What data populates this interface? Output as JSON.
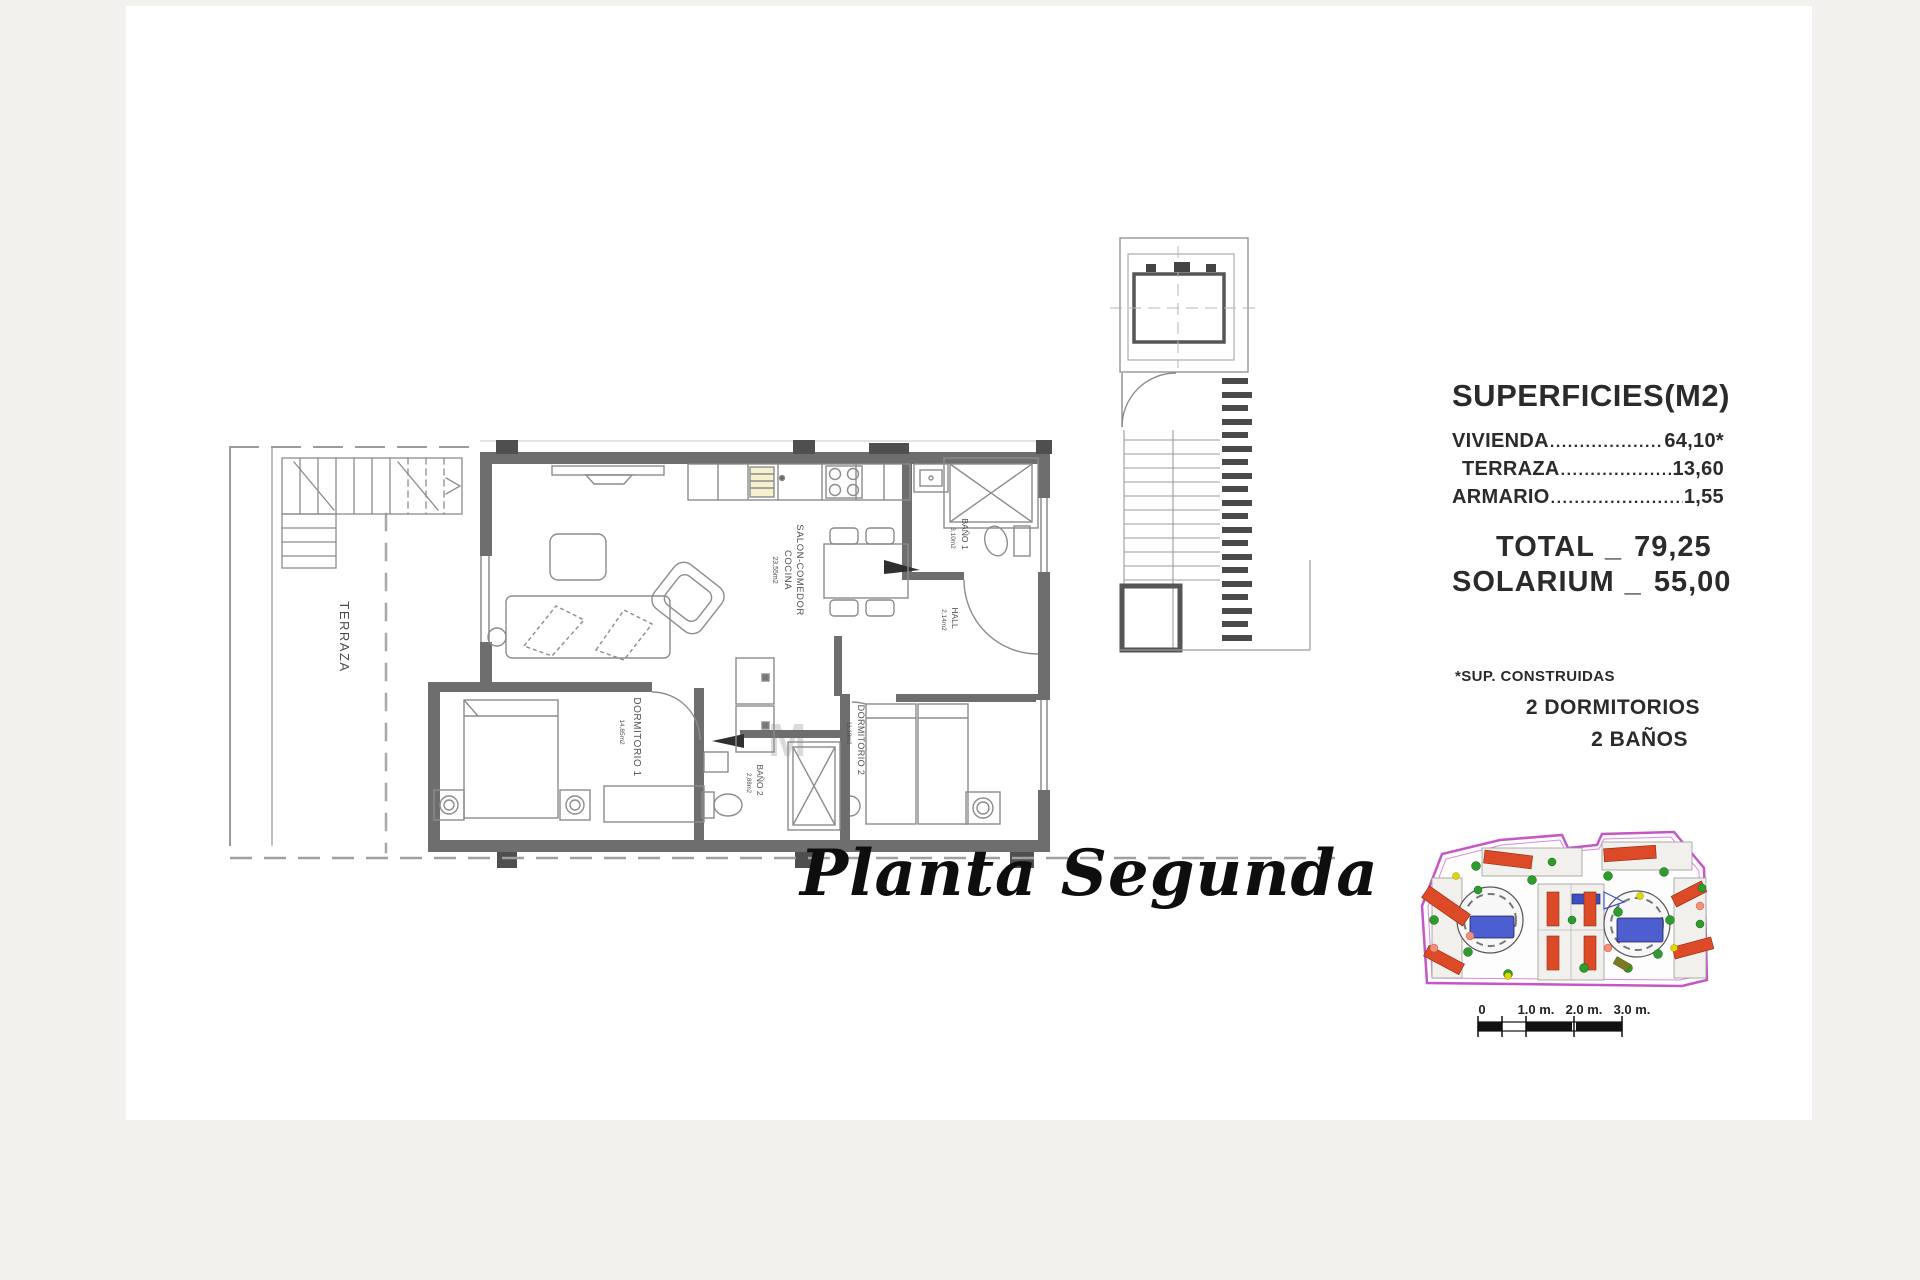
{
  "title": "Planta Segunda",
  "panel": {
    "heading": "SUPERFICIES(M2)",
    "rows": [
      {
        "label": "VIVIENDA",
        "value": "64,10*"
      },
      {
        "label": "TERRAZA",
        "value": "13,60"
      },
      {
        "label": "ARMARIO",
        "value": "1,55"
      }
    ],
    "total": {
      "label": "TOTAL",
      "sep": "_",
      "value": "79,25"
    },
    "solarium": {
      "label": "SOLARIUM",
      "sep": "_",
      "value": "55,00"
    },
    "footnote": "*SUP. CONSTRUIDAS",
    "features": [
      "2 DORMITORIOS",
      "2 BAÑOS"
    ]
  },
  "plan": {
    "rooms": {
      "terraza": {
        "name": "TERRAZA"
      },
      "salon": {
        "line1": "SALON-COMEDOR",
        "line2": "COCINA",
        "area": "23,55m2"
      },
      "dormitorio1": {
        "name": "DORMITORIO 1",
        "area": "14,85m2"
      },
      "dormitorio2": {
        "name": "DORMITORIO 2",
        "area": "11,18m2"
      },
      "bano1": {
        "name": "BAÑO 1",
        "area": "3,10m2"
      },
      "bano2": {
        "name": "BAÑO 2",
        "area": "2,88m2"
      },
      "hall": {
        "name": "HALL",
        "area": "2,14m2"
      }
    },
    "watermark": "M O"
  },
  "scalebar": {
    "labels": [
      "0",
      "1.0 m.",
      "2.0 m.",
      "3.0 m."
    ]
  },
  "colors": {
    "boundary_magenta": "#c556c5",
    "roof_red": "#dc4a28",
    "tree_green": "#2f9b2f",
    "pool_blue": "#4d5fd0",
    "accent_yellow": "#e0d600"
  }
}
